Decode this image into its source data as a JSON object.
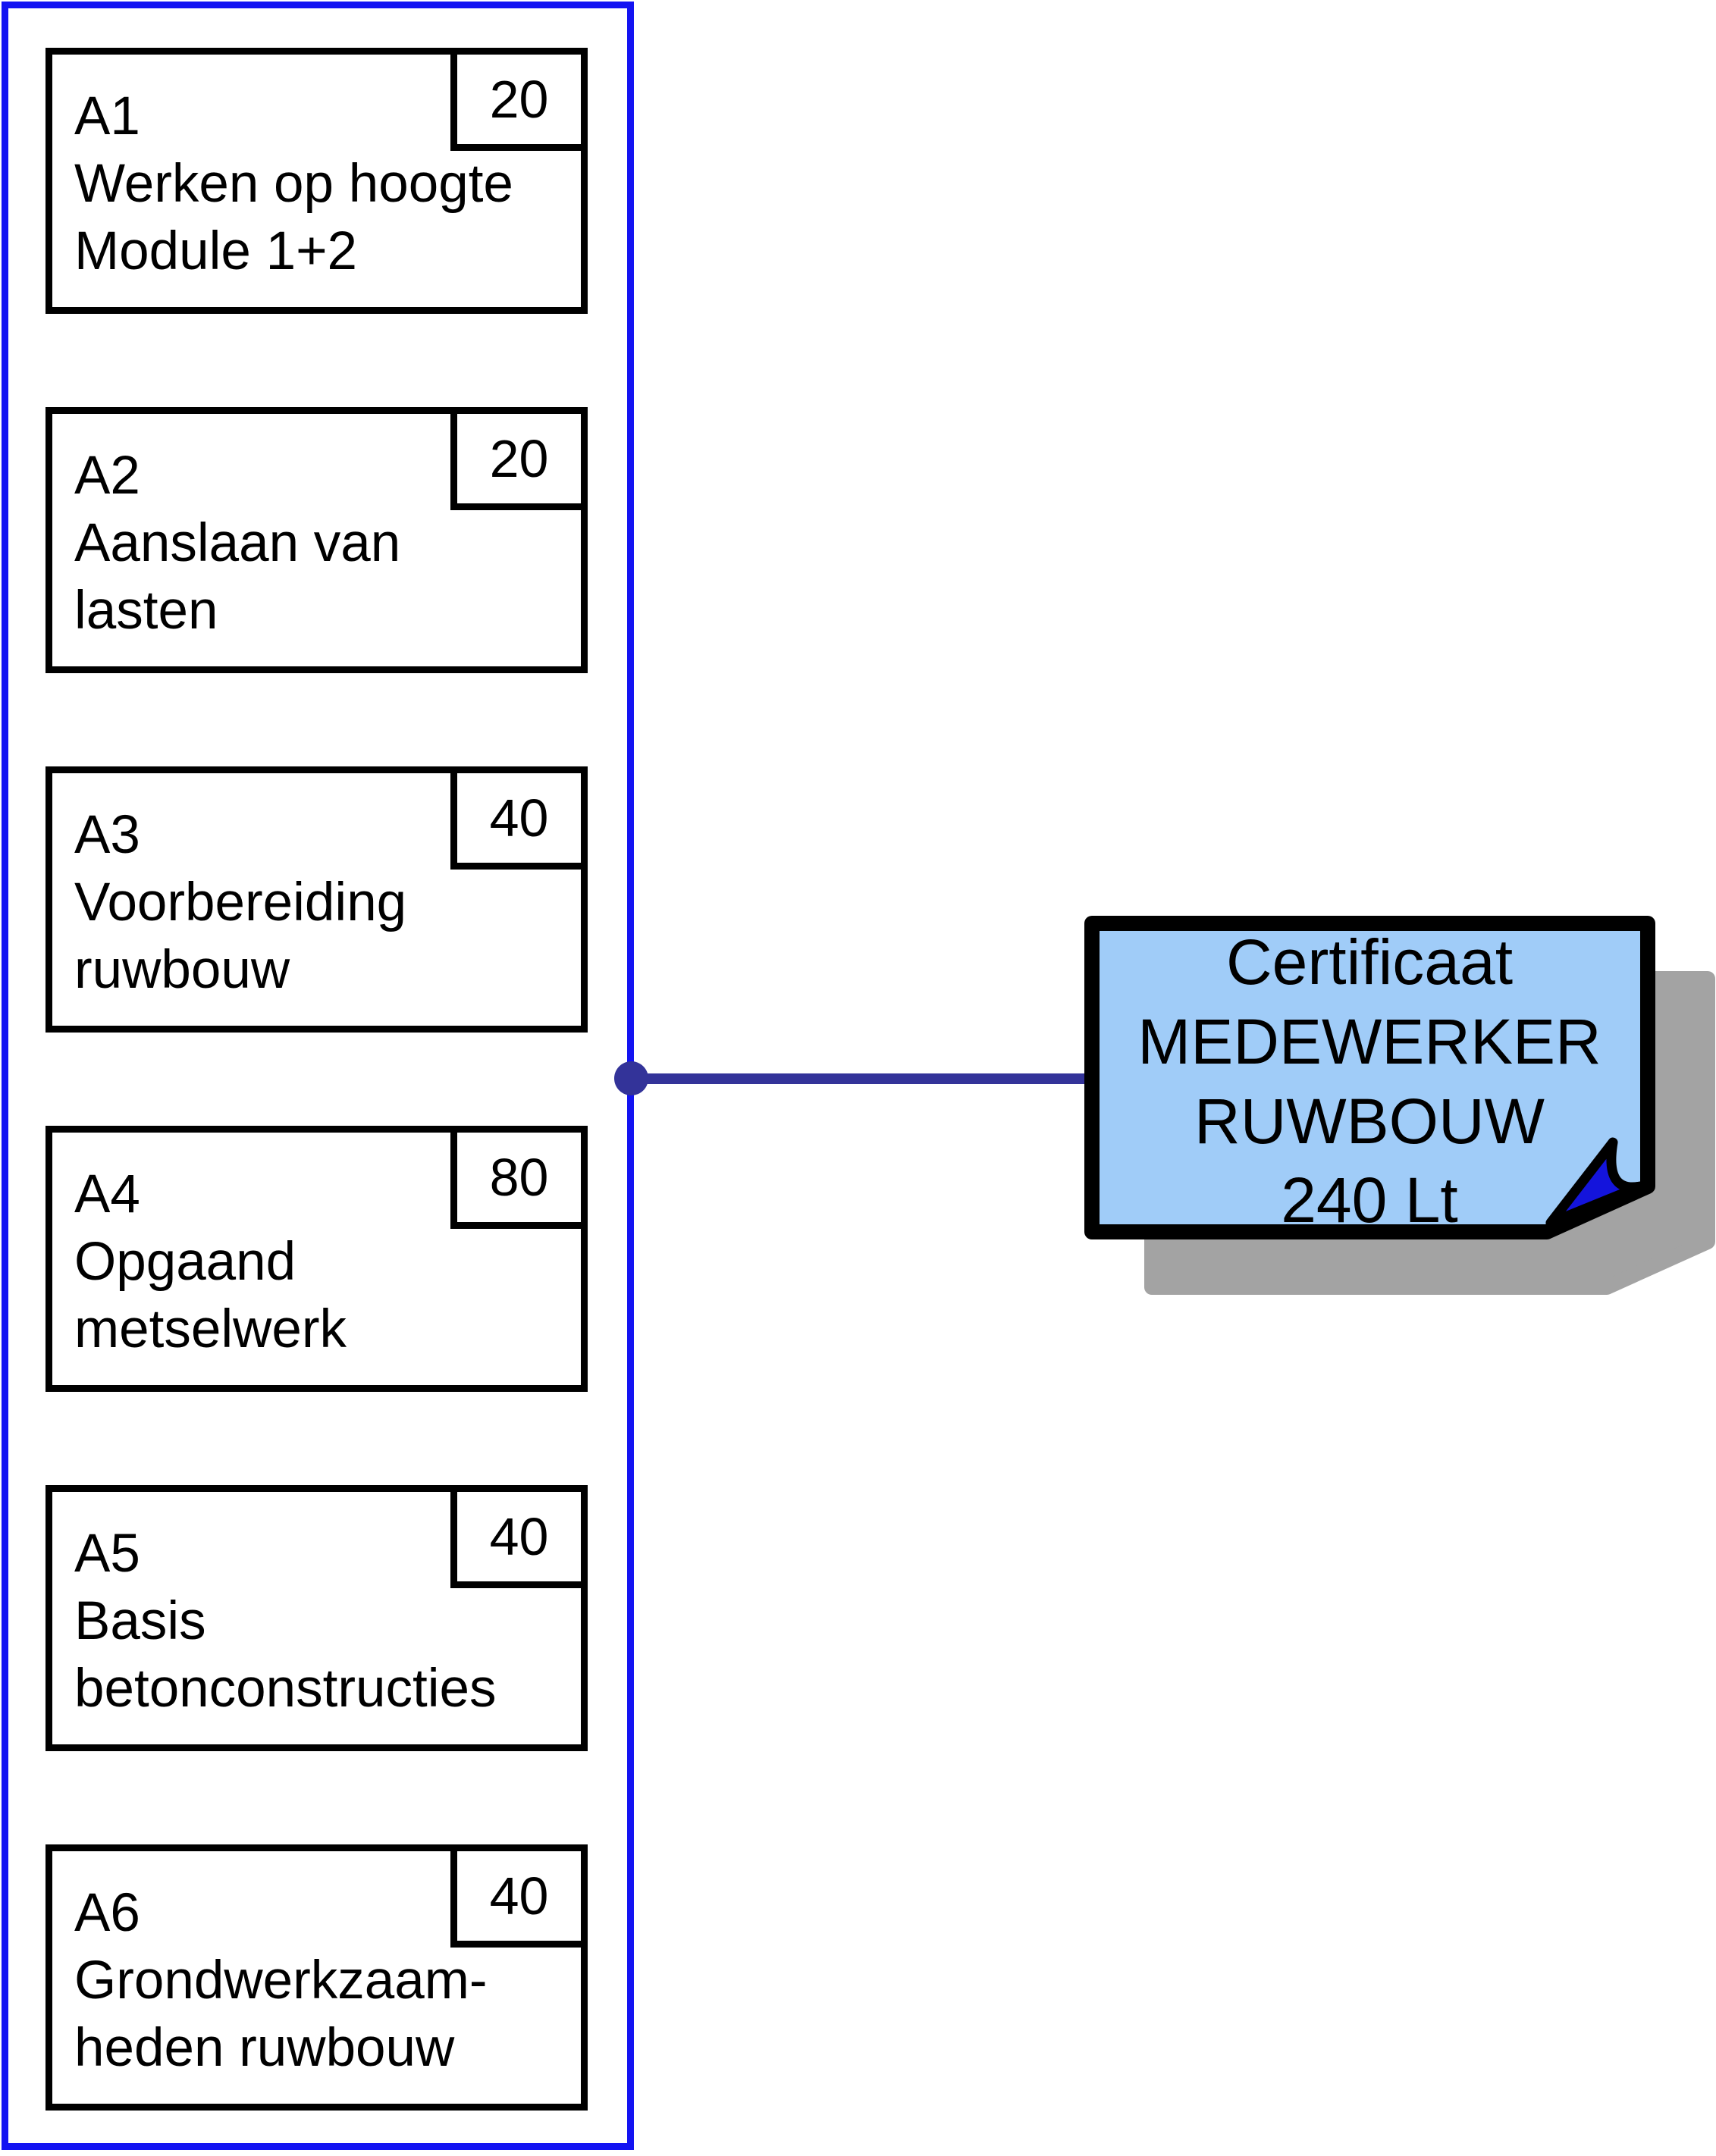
{
  "module_group": {
    "frame_color": "#1313F2",
    "modules": [
      {
        "id": "A1",
        "title": "Werken op hoogte\nModule 1+2",
        "hours": "20"
      },
      {
        "id": "A2",
        "title": "Aanslaan van\nlasten",
        "hours": "20"
      },
      {
        "id": "A3",
        "title": "Voorbereiding\nruwbouw",
        "hours": "40"
      },
      {
        "id": "A4",
        "title": "Opgaand\nmetselwerk",
        "hours": "80"
      },
      {
        "id": "A5",
        "title": "Basis\nbetonconstructies",
        "hours": "40"
      },
      {
        "id": "A6",
        "title": "Grondwerkzaam-\nheden ruwbouw",
        "hours": "40"
      }
    ]
  },
  "connector": {
    "color": "#333399"
  },
  "certificate": {
    "lines": [
      "Certificaat",
      "MEDEWERKER",
      "RUWBOUW",
      "240 Lt"
    ],
    "fill": "#A0CCF8",
    "fold_color": "#1414DC",
    "border_color": "#000000",
    "shadow_color": "#A3A3A3"
  }
}
